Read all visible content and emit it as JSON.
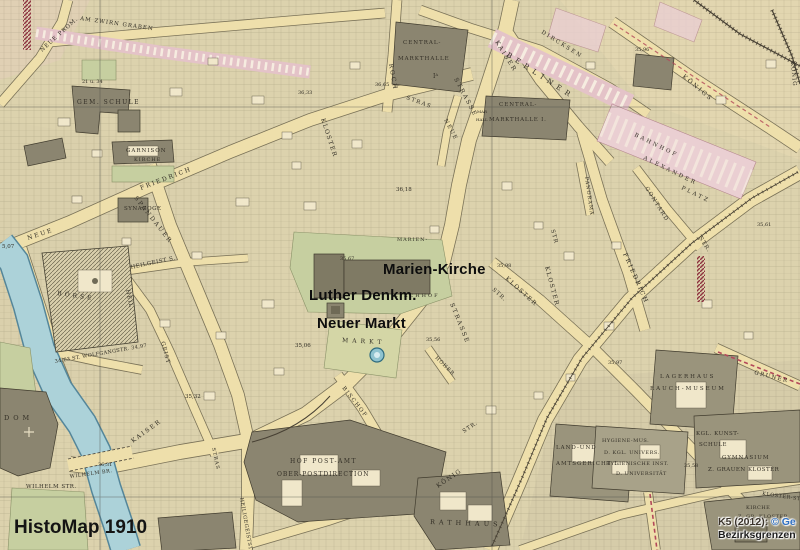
{
  "app": {
    "title": "HistoMap 1910"
  },
  "overlay": {
    "markers": [
      {
        "label": "Marien-Kirche"
      },
      {
        "label": "Luther Denkm."
      },
      {
        "label": "Neuer Markt"
      }
    ]
  },
  "attribution": {
    "source_prefix": "K5 (2012): ",
    "source_link": "© Ge",
    "layer": "Bezirksgrenzen"
  },
  "colors": {
    "paper": "#e9dcae",
    "street": "#eedfab",
    "block": "#dcd2ad",
    "building": "#8b8570",
    "water": "#acd2d9",
    "green": "#c6cfa0",
    "railway_pink": "#eacfd2",
    "boundary_red": "#8e3340",
    "link_blue": "#2f6fc2",
    "label_ink": "#332f26"
  },
  "map": {
    "labels": [
      "AM ZWIRN GRABEN",
      "NEUE PROM.",
      "GEM. SCHULE",
      "21 u. 34",
      "GARNISON",
      "KIRCHE",
      "FRIEDRICH",
      "SPANDAUER",
      "HEILGEIST S.",
      "SYNAGOGE",
      "NEUE",
      "5,07",
      "BÖRSE",
      "34,63 ST. WOLFGANGSTR. 34,97",
      "HEIL.",
      "GEIST",
      "DOM",
      "KAISER",
      "WILHELM BR.",
      "36,31",
      "35,32",
      "35,06",
      "KAISER",
      "STRASSE",
      "STRAS",
      "NEUE",
      "ROCH",
      "KLOSTER",
      "CENTRAL-",
      "MARKTHALLE",
      "Iᴬ",
      "CENTRAL-",
      "MARKTHALLE I.",
      "MAR",
      "HALL",
      "DIRCKSEN",
      "BERLINER",
      "KÖNIGS",
      "35,96",
      "KÖNIG",
      "BAHNHOF",
      "ALEXANDER",
      "PLATZ",
      "PANORAMA",
      "GONTARD",
      "STR.",
      "FRIEDRICH",
      "STR.",
      "KLOSTER",
      "35,98",
      "MARIEN-",
      "KIRCHHOF",
      "36,18",
      "MARKT",
      "BISCHOF",
      "HOHER",
      "35,56",
      "STRASSE",
      "KLOSTER",
      "35,67",
      "HOF POST-AMT",
      "OBER-POSTDIRECTION",
      "RATHHAUS",
      "LAND-UND",
      "AMTSGERICHT I.",
      "HYGIENE-MUS.",
      "D. KGL. UNIVERS.",
      "HYGIENISCHE INST.",
      "D. UNIVERSITÄT",
      "KGL. KUNST-",
      "SCHULE",
      "GYMNASIUM",
      "Z. GRAUEN KLOSTER",
      "KLOSTER-STR.",
      "KIRCHE",
      "Z. GR. KLOSTER",
      "35,58",
      "LAGERHAUS",
      "RAUCH-MUSEUM",
      "35,97",
      "GRUNER",
      "KÖNIG",
      "STR.",
      "WILHELM STR.",
      "35,61",
      "STR",
      "36,33",
      "36,65",
      "HEILIGEGEISTSTR.",
      "STRAS"
    ]
  }
}
